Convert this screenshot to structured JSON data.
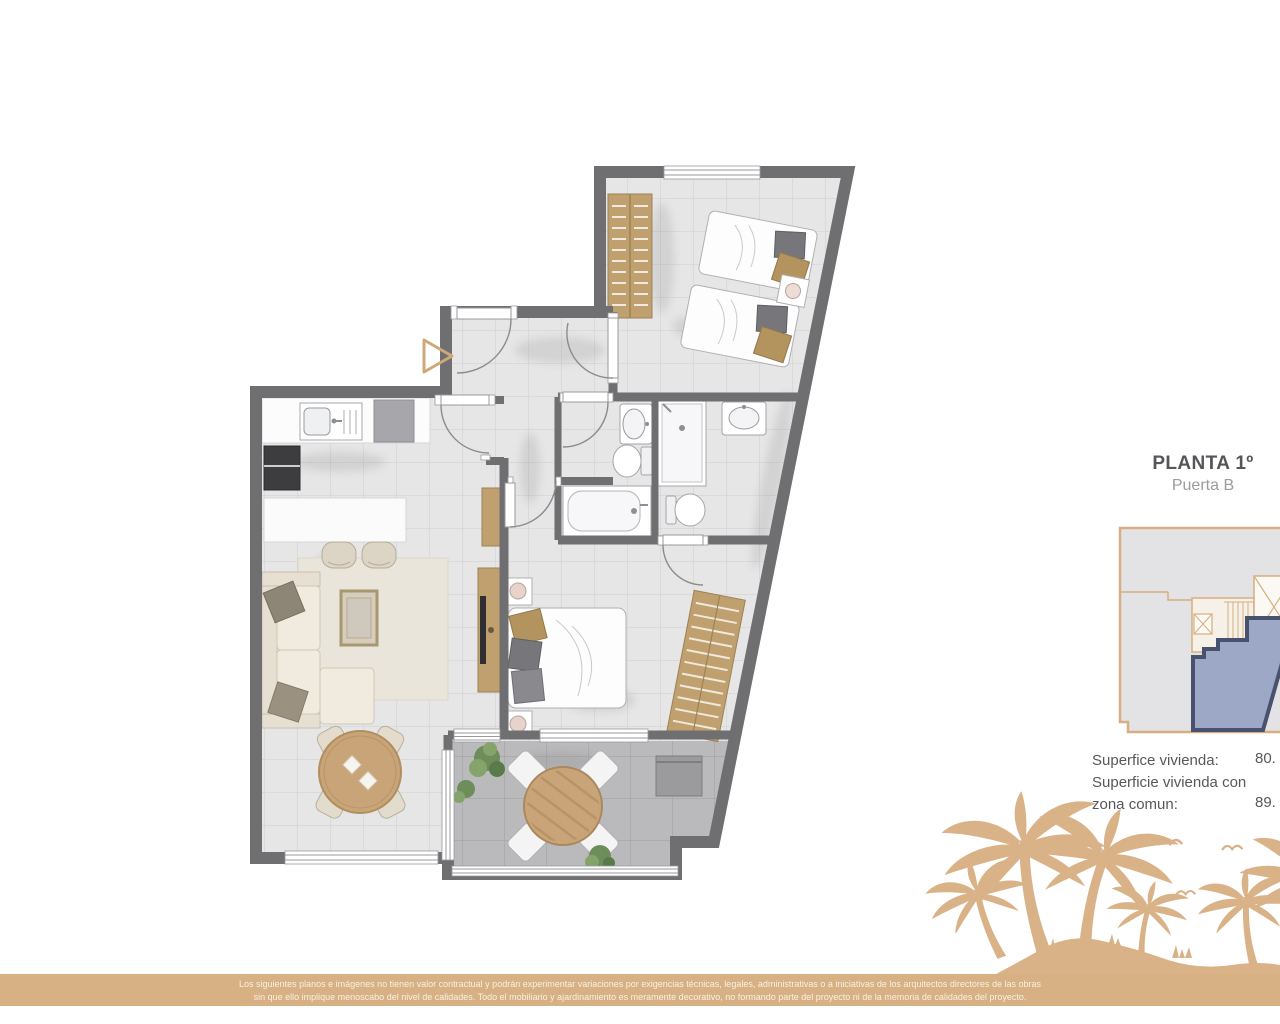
{
  "header": {
    "title": "PLANTA 1º",
    "subtitle": "Puerta B"
  },
  "surface_info": {
    "line1_label": "Superfice vivienda:",
    "line1_value": "80.",
    "line2_label": "Superficie vivienda con",
    "line3_label": "zona comun:",
    "line3_value": "89."
  },
  "disclaimer": {
    "line1": "Los siguientes planos e imágenes no tienen valor contractual y podrán experimentar variaciones por exigencias técnicas, legales, administrativas o a iniciativas de los arquitectos directores de las obras",
    "line2": "sin que ello implique menoscabo del nivel de calidades. Todo el mobiliario y ajardinamiento es meramente decorativo, no formando parte del proyecto ni de la memoria de calidades del proyecto."
  },
  "colors": {
    "accent_tan": "#d9b287",
    "band_background": "#d7b083",
    "wall_gray": "#6f6f71",
    "floor_tile": "#e6e6e7",
    "terrace_tile": "#bababc",
    "wood": "#c9a478",
    "highlight_unit_fill": "#9da8c7",
    "highlight_unit_border": "#48526e",
    "title_text": "#55565a",
    "subtitle_text": "#9b9ca0"
  }
}
